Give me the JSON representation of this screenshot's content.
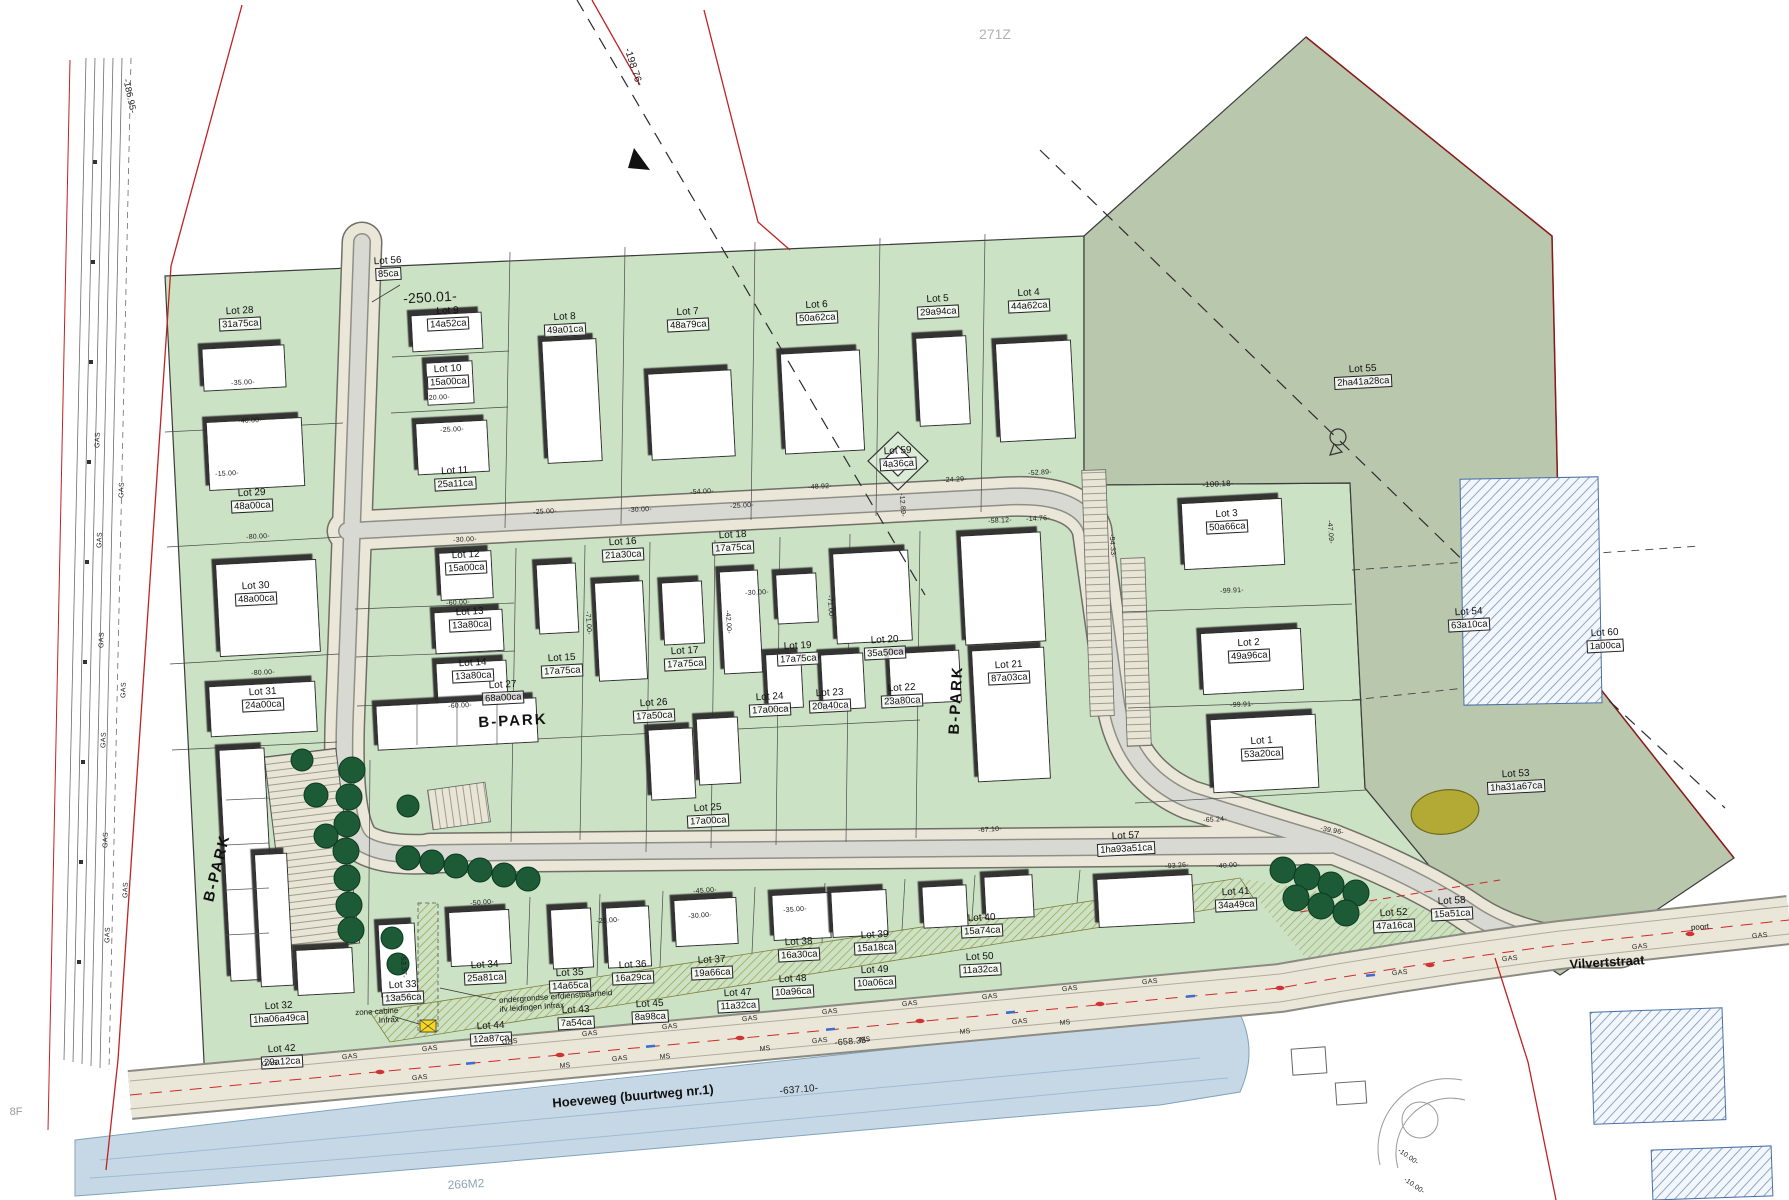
{
  "map": {
    "b_park": "B-PARK",
    "streets": {
      "hoeveweg": "Hoeveweg (buurtweg nr.1)",
      "vilvertstraat": "Vilvertstraat"
    },
    "refs": {
      "r271z": "271Z",
      "r266m2": "266M2",
      "r8f": "8F",
      "poort": "poort"
    },
    "notes": {
      "cabine_line1": "zone cabine",
      "cabine_line2": "Infrax",
      "erf_line1": "ondergrondse erfdienstbaarheid",
      "erf_line2": "ifv leidingen Infrax"
    },
    "utility": {
      "gas": "GAS",
      "ms": "MS"
    },
    "colors": {
      "development_green": "#cbe2c4",
      "field_sage": "#b9c7ac",
      "water_blue": "#c6d8e5",
      "road_beige": "#ebe7d8",
      "boundary_red": "#c02222",
      "pond_olive": "#b3aa35",
      "cabine_yellow": "#f6d71f"
    }
  },
  "lots": [
    {
      "id": "Lot 1",
      "area": "53a20ca",
      "x": 1262,
      "y": 748
    },
    {
      "id": "Lot 2",
      "area": "49a96ca",
      "x": 1249,
      "y": 650
    },
    {
      "id": "Lot 3",
      "area": "50a66ca",
      "x": 1227,
      "y": 521
    },
    {
      "id": "Lot 4",
      "area": "44a62ca",
      "x": 1029,
      "y": 300
    },
    {
      "id": "Lot 5",
      "area": "29a94ca",
      "x": 938,
      "y": 306
    },
    {
      "id": "Lot 6",
      "area": "50a62ca",
      "x": 817,
      "y": 312
    },
    {
      "id": "Lot 7",
      "area": "48a79ca",
      "x": 688,
      "y": 319
    },
    {
      "id": "Lot 8",
      "area": "49a01ca",
      "x": 565,
      "y": 324
    },
    {
      "id": "Lot 9",
      "area": "14a52ca",
      "x": 448,
      "y": 318
    },
    {
      "id": "Lot 10",
      "area": "15a00ca",
      "x": 448,
      "y": 376
    },
    {
      "id": "Lot 11",
      "area": "25a11ca",
      "x": 455,
      "y": 478
    },
    {
      "id": "Lot 12",
      "area": "15a00ca",
      "x": 466,
      "y": 562
    },
    {
      "id": "Lot 13",
      "area": "13a80ca",
      "x": 470,
      "y": 619
    },
    {
      "id": "Lot 14",
      "area": "13a80ca",
      "x": 473,
      "y": 670
    },
    {
      "id": "Lot 15",
      "area": "17a75ca",
      "x": 562,
      "y": 665
    },
    {
      "id": "Lot 16",
      "area": "21a30ca",
      "x": 623,
      "y": 549
    },
    {
      "id": "Lot 17",
      "area": "17a75ca",
      "x": 685,
      "y": 658
    },
    {
      "id": "Lot 18",
      "area": "17a75ca",
      "x": 733,
      "y": 542
    },
    {
      "id": "Lot 19",
      "area": "17a75ca",
      "x": 798,
      "y": 653
    },
    {
      "id": "Lot 20",
      "area": "35a50ca",
      "x": 885,
      "y": 647
    },
    {
      "id": "Lot 21",
      "area": "87a03ca",
      "x": 1009,
      "y": 672
    },
    {
      "id": "Lot 22",
      "area": "23a80ca",
      "x": 902,
      "y": 695
    },
    {
      "id": "Lot 23",
      "area": "20a40ca",
      "x": 830,
      "y": 700
    },
    {
      "id": "Lot 24",
      "area": "17a00ca",
      "x": 770,
      "y": 704
    },
    {
      "id": "Lot 25",
      "area": "17a00ca",
      "x": 708,
      "y": 815
    },
    {
      "id": "Lot 26",
      "area": "17a50ca",
      "x": 654,
      "y": 710
    },
    {
      "id": "Lot 27",
      "area": "68a00ca",
      "x": 503,
      "y": 692
    },
    {
      "id": "Lot 28",
      "area": "31a75ca",
      "x": 240,
      "y": 318
    },
    {
      "id": "Lot 29",
      "area": "48a00ca",
      "x": 252,
      "y": 500
    },
    {
      "id": "Lot 30",
      "area": "48a00ca",
      "x": 256,
      "y": 593
    },
    {
      "id": "Lot 31",
      "area": "24a00ca",
      "x": 263,
      "y": 699
    },
    {
      "id": "Lot 32",
      "area": "1ha06a49ca",
      "x": 279,
      "y": 1013
    },
    {
      "id": "Lot 33",
      "area": "13a56ca",
      "x": 403,
      "y": 992
    },
    {
      "id": "Lot 34",
      "area": "25a81ca",
      "x": 485,
      "y": 972
    },
    {
      "id": "Lot 35",
      "area": "14a65ca",
      "x": 570,
      "y": 980
    },
    {
      "id": "Lot 36",
      "area": "16a29ca",
      "x": 633,
      "y": 972
    },
    {
      "id": "Lot 37",
      "area": "19a66ca",
      "x": 712,
      "y": 967
    },
    {
      "id": "Lot 38",
      "area": "16a30ca",
      "x": 799,
      "y": 949
    },
    {
      "id": "Lot 39",
      "area": "15a18ca",
      "x": 875,
      "y": 942
    },
    {
      "id": "Lot 40",
      "area": "15a74ca",
      "x": 982,
      "y": 925
    },
    {
      "id": "Lot 41",
      "area": "34a49ca",
      "x": 1236,
      "y": 899
    },
    {
      "id": "Lot 42",
      "area": "29a12ca",
      "x": 282,
      "y": 1056
    },
    {
      "id": "Lot 43",
      "area": "7a54ca",
      "x": 576,
      "y": 1017
    },
    {
      "id": "Lot 44",
      "area": "12a87ca",
      "x": 491,
      "y": 1033
    },
    {
      "id": "Lot 45",
      "area": "8a98ca",
      "x": 650,
      "y": 1011
    },
    {
      "id": "Lot 47",
      "area": "11a32ca",
      "x": 738,
      "y": 1000
    },
    {
      "id": "Lot 48",
      "area": "10a96ca",
      "x": 793,
      "y": 986
    },
    {
      "id": "Lot 49",
      "area": "10a06ca",
      "x": 875,
      "y": 977
    },
    {
      "id": "Lot 50",
      "area": "11a32ca",
      "x": 980,
      "y": 964
    },
    {
      "id": "Lot 52",
      "area": "47a16ca",
      "x": 1394,
      "y": 920
    },
    {
      "id": "Lot 53",
      "area": "1ha31a67ca",
      "x": 1516,
      "y": 781
    },
    {
      "id": "Lot 54",
      "area": "63a10ca",
      "x": 1469,
      "y": 619
    },
    {
      "id": "Lot 55",
      "area": "2ha41a28ca",
      "x": 1363,
      "y": 376
    },
    {
      "id": "Lot 56",
      "area": "85ca",
      "x": 388,
      "y": 268
    },
    {
      "id": "Lot 57",
      "area": "1ha93a51ca",
      "x": 1126,
      "y": 843
    },
    {
      "id": "Lot 58",
      "area": "15a51ca",
      "x": 1452,
      "y": 908
    },
    {
      "id": "Lot 59",
      "area": "4a36ca",
      "x": 898,
      "y": 458
    },
    {
      "id": "Lot 60",
      "area": "1a00ca",
      "x": 1605,
      "y": 640
    }
  ],
  "dims": [
    {
      "t": "-250.01-",
      "x": 430,
      "y": 297,
      "r": -3,
      "s": 14
    },
    {
      "t": "-198.76-",
      "x": 633,
      "y": 67,
      "r": 72,
      "s": 10
    },
    {
      "t": "-186.95-",
      "x": 130,
      "y": 96,
      "r": 78,
      "s": 9
    },
    {
      "t": "-637.10-",
      "x": 799,
      "y": 1090,
      "r": -5,
      "s": 10
    },
    {
      "t": "-658.35-",
      "x": 852,
      "y": 1041,
      "r": -5,
      "s": 9
    },
    {
      "t": "-100.18-",
      "x": 1218,
      "y": 484,
      "r": -3,
      "s": 8
    },
    {
      "t": "-52.89-",
      "x": 1040,
      "y": 473,
      "r": -3
    },
    {
      "t": "-58.12-",
      "x": 1000,
      "y": 521,
      "r": -3
    },
    {
      "t": "-14.76-",
      "x": 1038,
      "y": 519,
      "r": -3
    },
    {
      "t": "-54.33-",
      "x": 1112,
      "y": 546,
      "r": 86
    },
    {
      "t": "-99.91-",
      "x": 1232,
      "y": 591,
      "r": -3
    },
    {
      "t": "-99.91-",
      "x": 1242,
      "y": 705,
      "r": -3
    },
    {
      "t": "-67.10-",
      "x": 990,
      "y": 830,
      "r": -4
    },
    {
      "t": "-65.24-",
      "x": 1215,
      "y": 820,
      "r": -3
    },
    {
      "t": "-39.96-",
      "x": 1332,
      "y": 831,
      "r": 10
    },
    {
      "t": "-93.26-",
      "x": 1177,
      "y": 866,
      "r": -4
    },
    {
      "t": "-48.92-",
      "x": 820,
      "y": 487,
      "r": -3
    },
    {
      "t": "-54.00-",
      "x": 702,
      "y": 492,
      "r": -3
    },
    {
      "t": "-35.00-",
      "x": 243,
      "y": 383,
      "r": -3
    },
    {
      "t": "-40.00-",
      "x": 250,
      "y": 421,
      "r": -3
    },
    {
      "t": "-15.00-",
      "x": 227,
      "y": 474,
      "r": -3
    },
    {
      "t": "-80.00-",
      "x": 258,
      "y": 537,
      "r": -3
    },
    {
      "t": "-80.00-",
      "x": 263,
      "y": 673,
      "r": -3
    },
    {
      "t": "-60.00-",
      "x": 458,
      "y": 603,
      "r": -3
    },
    {
      "t": "-60.00-",
      "x": 460,
      "y": 706,
      "r": -3
    },
    {
      "t": "-30.00-",
      "x": 465,
      "y": 540,
      "r": -3
    },
    {
      "t": "-25.00-",
      "x": 452,
      "y": 430,
      "r": -3
    },
    {
      "t": "-20.00-",
      "x": 438,
      "y": 398,
      "r": -3
    },
    {
      "t": "-45.00-",
      "x": 705,
      "y": 891,
      "r": -4
    },
    {
      "t": "-50.00-",
      "x": 482,
      "y": 903,
      "r": -4
    },
    {
      "t": "-53.37-",
      "x": 403,
      "y": 966,
      "r": 86
    },
    {
      "t": "-25.00-",
      "x": 608,
      "y": 921,
      "r": -4
    },
    {
      "t": "-30.00-",
      "x": 700,
      "y": 916,
      "r": -4
    },
    {
      "t": "-35.00-",
      "x": 795,
      "y": 910,
      "r": -4
    },
    {
      "t": "-40.00-",
      "x": 1228,
      "y": 866,
      "r": -4
    },
    {
      "t": "-47.09-",
      "x": 1330,
      "y": 532,
      "r": 86
    },
    {
      "t": "-24.29-",
      "x": 955,
      "y": 480,
      "r": -3
    },
    {
      "t": "-12.89-",
      "x": 902,
      "y": 505,
      "r": 86
    },
    {
      "t": "-71.00-",
      "x": 588,
      "y": 623,
      "r": 86
    },
    {
      "t": "-71.00-",
      "x": 830,
      "y": 607,
      "r": 86
    },
    {
      "t": "-42.00-",
      "x": 728,
      "y": 622,
      "r": 86
    },
    {
      "t": "-30.00-",
      "x": 757,
      "y": 593,
      "r": -3
    },
    {
      "t": "-25.00-",
      "x": 545,
      "y": 512,
      "r": -3
    },
    {
      "t": "-30.00-",
      "x": 640,
      "y": 510,
      "r": -3
    },
    {
      "t": "-25.00-",
      "x": 742,
      "y": 506,
      "r": -3
    },
    {
      "t": "-10.00-",
      "x": 1408,
      "y": 1157,
      "r": 35
    },
    {
      "t": "-10.00-",
      "x": 1414,
      "y": 1186,
      "r": 35
    }
  ]
}
